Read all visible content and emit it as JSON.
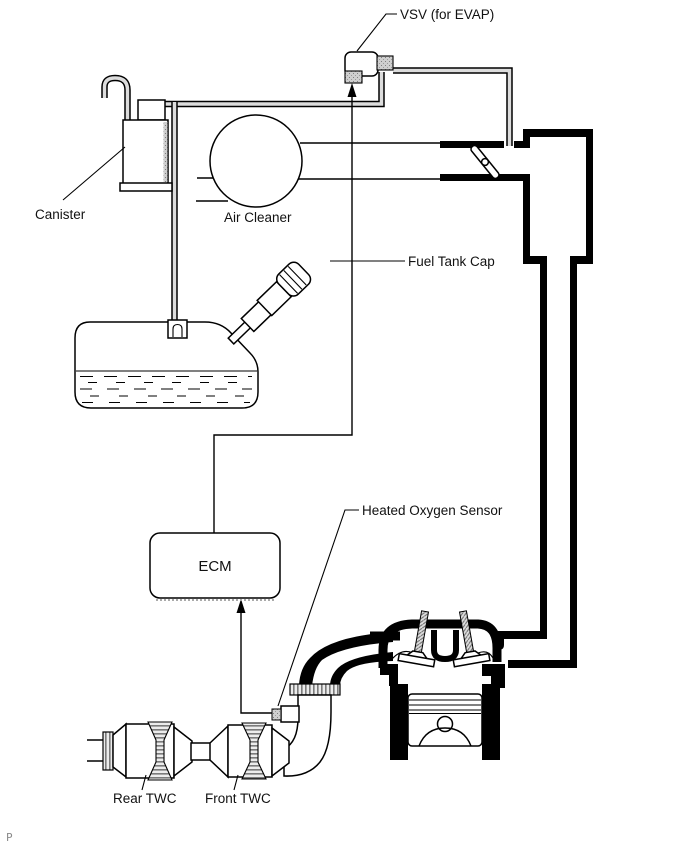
{
  "diagram": {
    "labels": {
      "vsv": "VSV (for EVAP)",
      "canister": "Canister",
      "air_cleaner": "Air Cleaner",
      "fuel_tank_cap": "Fuel Tank Cap",
      "heated_oxygen_sensor": "Heated Oxygen Sensor",
      "ecm": "ECM",
      "rear_twc": "Rear TWC",
      "front_twc": "Front TWC"
    },
    "watermark": "P",
    "colors": {
      "line": "#000000",
      "background": "#ffffff",
      "pipe_core": "#dcdcdc",
      "hatch": "#666666",
      "watermark": "#8a8a8a"
    }
  }
}
